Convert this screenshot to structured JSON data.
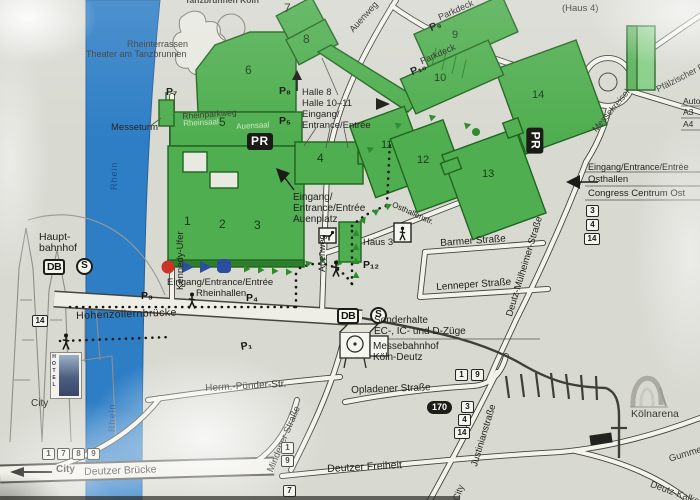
{
  "colors": {
    "paper": "#d8d9d1",
    "river": "#2e7ec6",
    "river_label": "#14508f",
    "hall_green": "#4fae4f",
    "hall_green_light": "#86cd86",
    "hall_green_dark": "#2a7a2a",
    "road_fill": "#f3f3ec",
    "ink": "#22221f"
  },
  "water": {
    "rhein_upper": "Rhein",
    "rhein_lower": "Rhein"
  },
  "halls": {
    "h1": "1",
    "h2": "2",
    "h3": "3",
    "h4": "4",
    "h5": "5",
    "h6": "6",
    "h7": "7",
    "h8": "8",
    "h11": "11",
    "h12": "12",
    "h13": "13",
    "h14": "14",
    "parkdeck9": {
      "label": "Parkdeck",
      "p": "P₉",
      "num": "9"
    },
    "parkdeck10": {
      "label": "Parkdeck",
      "p": "P₁₀",
      "num": "10"
    },
    "rheinsaal": "Rheinsaal",
    "auensaal": "Auensaal",
    "haus3": "Haus 3",
    "haus4": "(Haus 4)"
  },
  "parking": {
    "p1": "P₁",
    "p3": "P₃",
    "p4": "P₄",
    "p5": "P₅",
    "p7": "P₇",
    "p8": "P₈",
    "p12": "P₁₂",
    "pr": "PR"
  },
  "entrances": {
    "rheinhallen": {
      "l1": "Eingang/Entrance/Entrée",
      "l2": "Rheinhallen"
    },
    "auenplatz": {
      "l1": "Eingang/",
      "l2": "Entrance/Entrée",
      "l3": "Auenplatz"
    },
    "halle8": {
      "l1": "Halle 8",
      "l2": "Halle 10–11",
      "l3": "Eingang/",
      "l4": "Entrance/Entrée"
    },
    "osthallen": {
      "l1": "Eingang/Entrance/Entrée",
      "l2": "Osthallen",
      "l3": "Congress Centrum Ost"
    }
  },
  "streets": {
    "kennedy_ufer": "Kennedy-Ufer",
    "rheinparkweg": "Rheinparkweg",
    "auenweg_top": "Auenweg",
    "auenweg_mid": "Auenweg",
    "osthallenstr": "Osthallenstr.",
    "barmer": "Barmer Straße",
    "lenneper": "Lenneper Straße",
    "deutz_muelheimer": "Deutz-Mülheimer-Straße",
    "messekreisel": "Messekreisel",
    "pfaelzischer_ring": "Pfälzischer Ring",
    "hohenzollernbruecke": "Hohenzollernbrücke",
    "opladener": "Opladener Straße",
    "herm_puender": "Herm.-Pünder-Str.",
    "mindener": "Mindener Straße",
    "justinian": "Justinianstraße",
    "deutzer_freiheit": "Deutzer Freiheit",
    "deutzer_bruecke": "Deutzer Brücke",
    "gummersbacher": "Gummersbacher Str.",
    "deutz_kalker": "Deutz-Kalker Str."
  },
  "transit": {
    "hauptbahnhof_l1": "Haupt-",
    "hauptbahnhof_l2": "bahnhof",
    "db": "DB",
    "s": "S",
    "sonderhalte_l1": "Sonderhalte",
    "sonderhalte_l2": "EC-, IC- und D-Züge",
    "messebahnhof_l1": "Messebahnhof",
    "messebahnhof_l2": "Köln-Deutz",
    "autobahn": "Autobahn",
    "a3": "A3",
    "a4": "A4",
    "bus_170": "170",
    "lines_dom": [
      "14"
    ],
    "lines_congress_ost": [
      "3",
      "4",
      "14"
    ],
    "lines_messebahnhof": [
      "1",
      "9"
    ],
    "lines_opladener": [
      "3",
      "4",
      "14"
    ],
    "lines_mindener": [
      "1",
      "9"
    ],
    "lines_deutzer_freiheit": [
      "7"
    ],
    "lines_city": [
      "1",
      "7",
      "8",
      "9"
    ]
  },
  "landmarks": {
    "tanzbrunnen": "Tanzbrunnen Köln",
    "rheinterrassen": "Rheinterrassen",
    "theater": "Theater am Tanzbrunnen",
    "messeturm": "Messeturm",
    "koelnarena": "Kölnarena",
    "hotel": "HOTEL",
    "city_west": "City",
    "city_arrow": "City",
    "city_south": "City"
  }
}
